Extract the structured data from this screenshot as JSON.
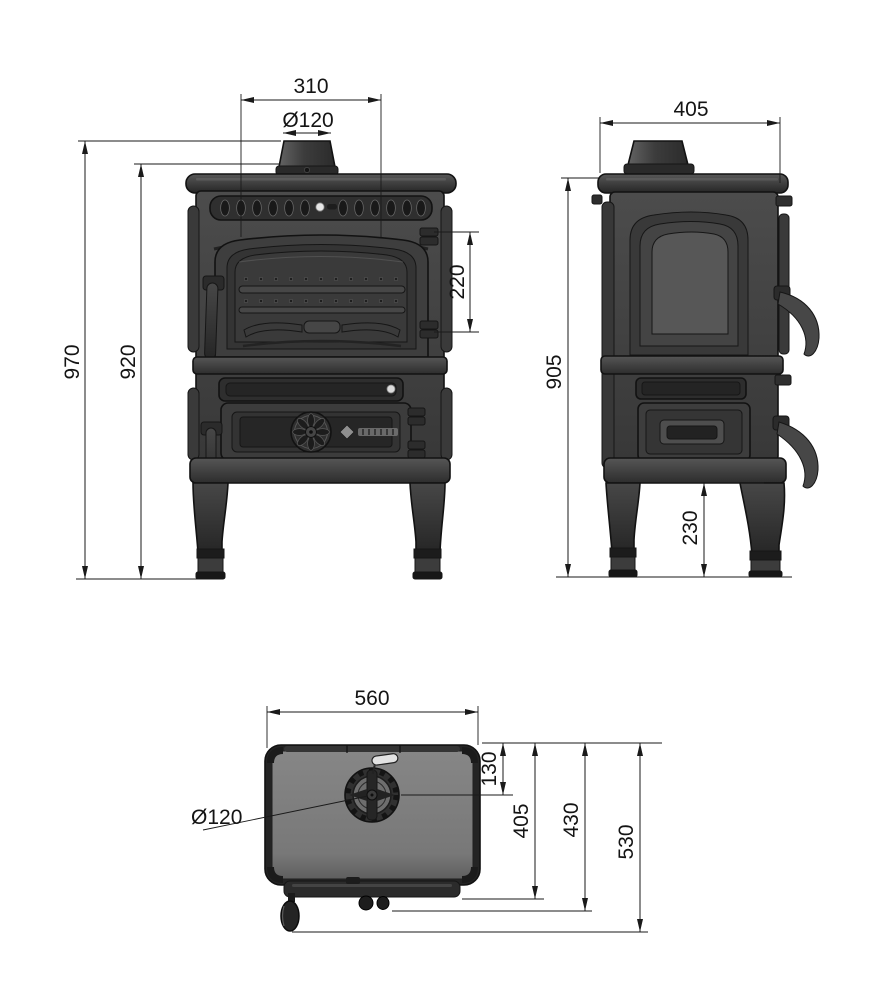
{
  "drawing": {
    "front_view": {
      "top_width": "310",
      "flue_diameter": "Ø120",
      "overall_height": "970",
      "body_height": "920",
      "door_window_height": "220"
    },
    "side_view": {
      "depth": "405",
      "body_height": "905",
      "floor_clearance": "230"
    },
    "top_view": {
      "width": "560",
      "flue_center_offset": "130",
      "flue_diameter": "Ø120",
      "top_plate_depth": "405",
      "body_depth": "430",
      "overall_depth": "530"
    },
    "colors": {
      "background": "#ffffff",
      "line": "#1a1a1a",
      "stove_dark": "#2e2e2e",
      "stove_mid": "#454545",
      "top_surface": "#7c7c7c"
    }
  }
}
